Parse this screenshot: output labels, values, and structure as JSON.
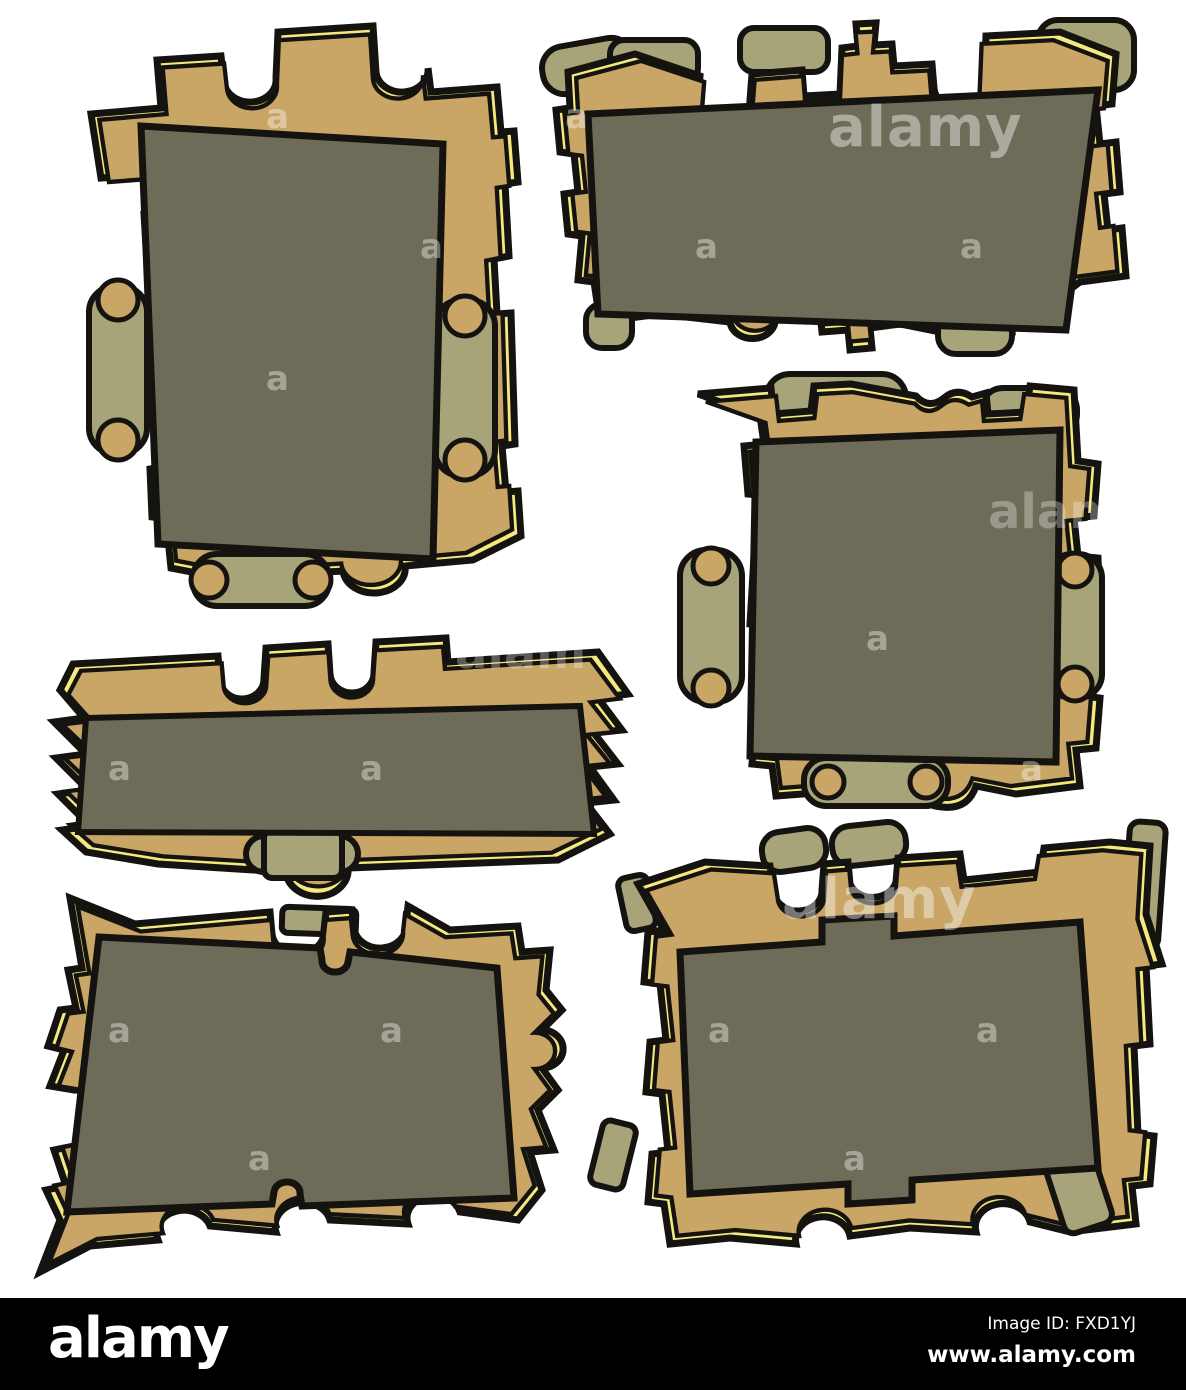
{
  "palette": {
    "background": "#ffffff",
    "frame_tan": "#c9a566",
    "trim_yellow": "#f5e87e",
    "panel_olive": "#6e6c58",
    "scroll_khaki": "#a8a47a",
    "outline_black": "#141310",
    "footer_black": "#000000",
    "watermark_white": "#ffffff"
  },
  "watermark": {
    "tile_letter": "a",
    "tile_word": "alamy",
    "tile_word_partial": "alam"
  },
  "footer": {
    "brand": "alamy",
    "image_id_label": "Image ID: FXD1YJ",
    "website": "www.alamy.com"
  },
  "frames": [
    {
      "id": "portrait-frame-top-left"
    },
    {
      "id": "landscape-frame-top-right"
    },
    {
      "id": "square-frame-middle-right"
    },
    {
      "id": "banner-frame-middle-left"
    },
    {
      "id": "tilted-frame-bottom-left"
    },
    {
      "id": "large-frame-bottom-right"
    }
  ]
}
